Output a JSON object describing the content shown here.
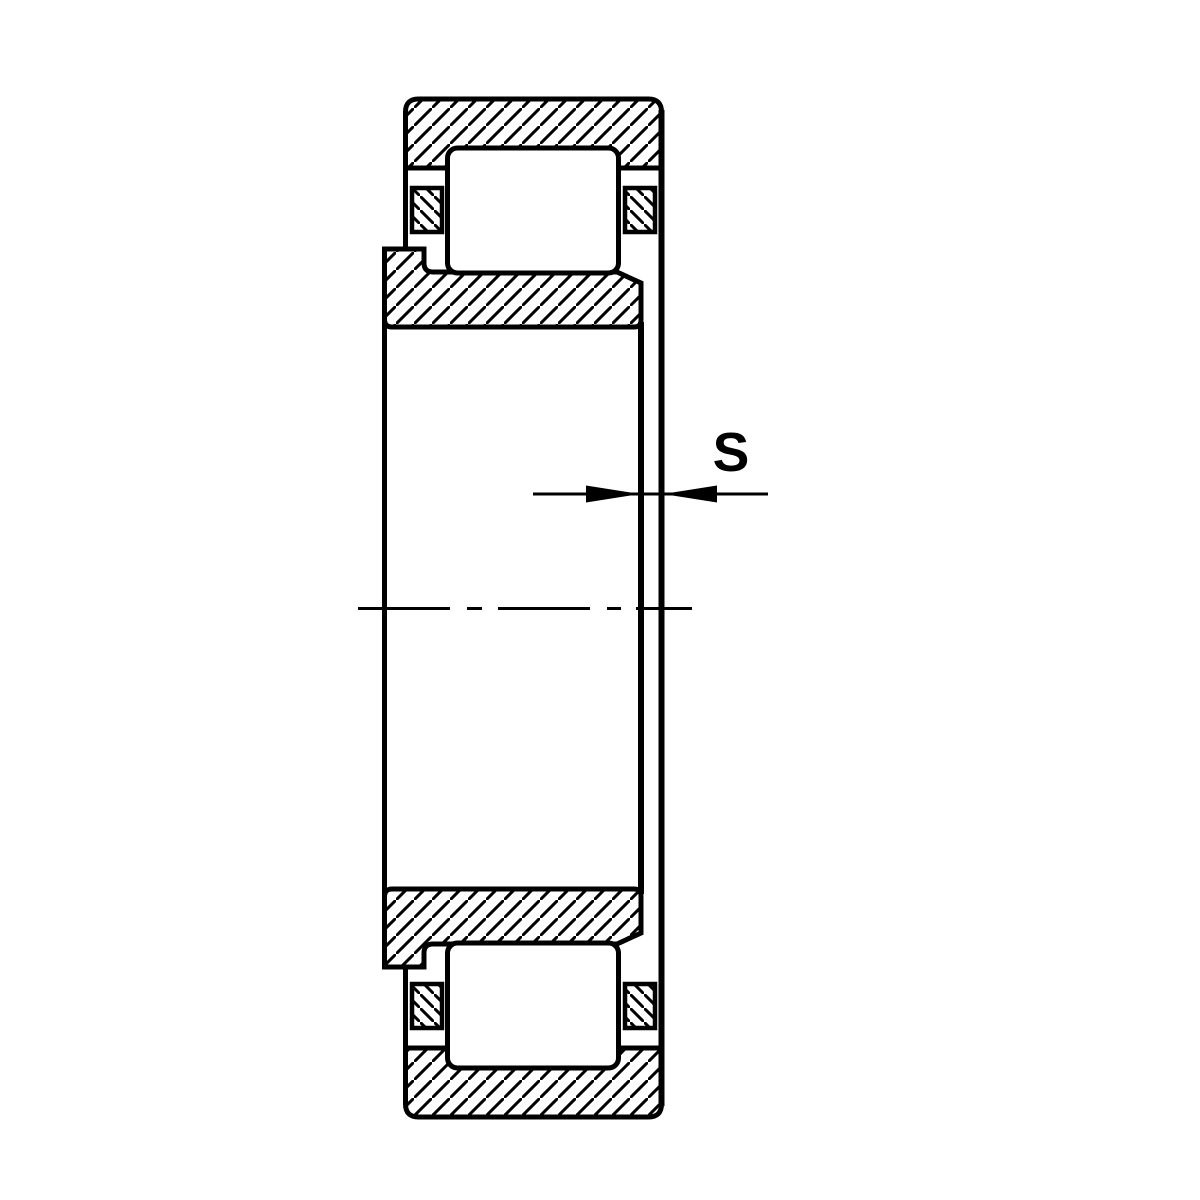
{
  "figure": {
    "kind": "technical-drawing",
    "subject": "cylindrical-roller-bearing-cross-section",
    "dimension_label": "S",
    "colors": {
      "line": "#000000",
      "background": "#ffffff"
    }
  }
}
